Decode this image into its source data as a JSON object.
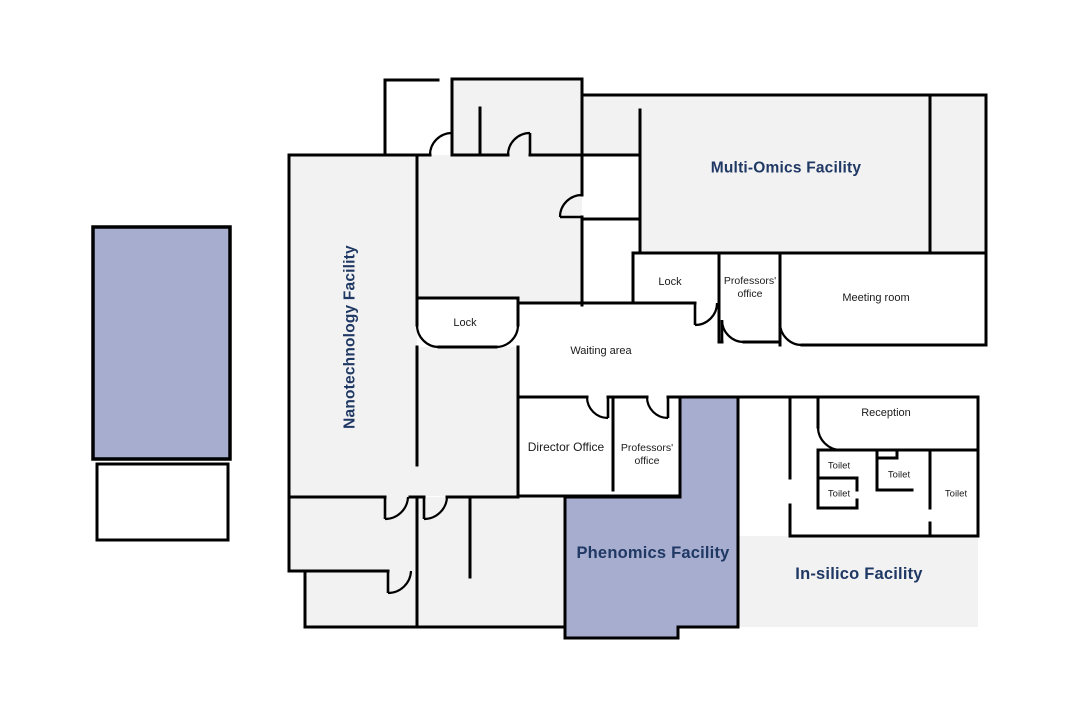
{
  "colors": {
    "wall": "#000000",
    "room_fill": "#f2f2f2",
    "highlight_fill": "#a6adcf",
    "facility_label": "#1f3864",
    "room_label": "#1a1a1a",
    "background": "#ffffff"
  },
  "facilities": {
    "nanotechnology": "Nanotechnology Facility",
    "multi_omics": "Multi-Omics Facility",
    "phenomics": "Phenomics Facility",
    "in_silico": "In-silico Facility"
  },
  "rooms": {
    "lock_top": "Lock",
    "professors_office_top": {
      "line1": "Professors'",
      "line2": "office"
    },
    "meeting_room": "Meeting room",
    "lock_side": "Lock",
    "waiting_area": "Waiting area",
    "director_office": "Director Office",
    "professors_office_lower": {
      "line1": "Professors'",
      "line2": "office"
    },
    "reception": "Reception",
    "toilets": [
      "Toilet",
      "Toilet",
      "Toilet",
      "Toilet"
    ]
  }
}
